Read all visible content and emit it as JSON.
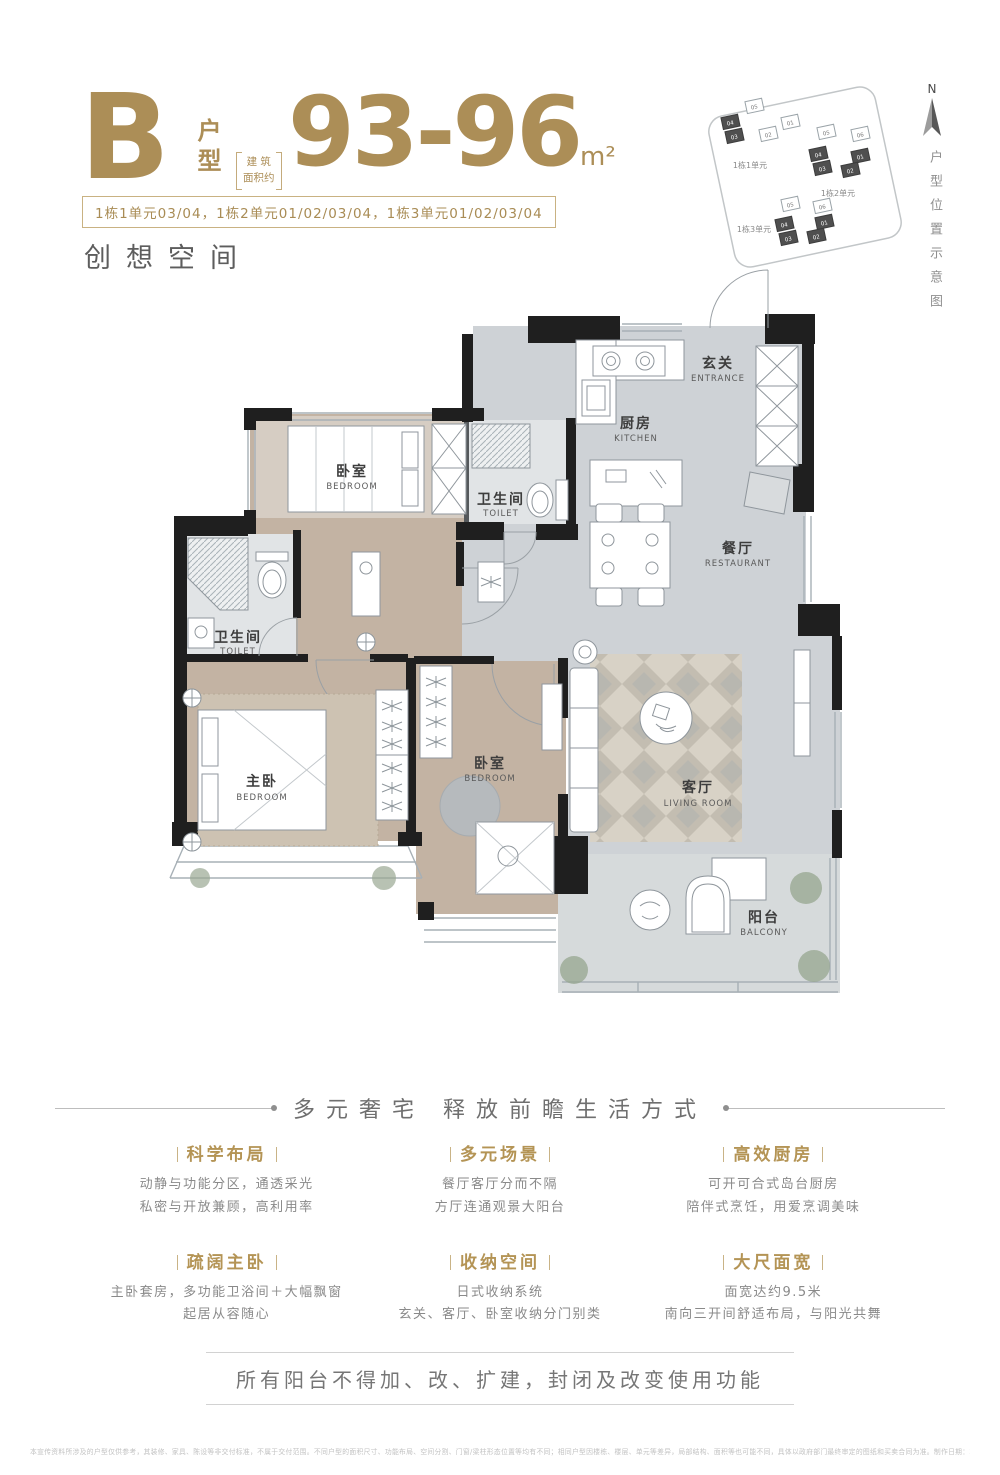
{
  "header": {
    "type_letter": "B",
    "type_label": "户型",
    "area_note1": "建 筑",
    "area_note2": "面积约",
    "area_value": "93-96",
    "area_unit": "m²",
    "units_line": "1栋1单元03/04，1栋2单元01/02/03/04，1栋3单元01/02/03/04",
    "slogan": "创想空间"
  },
  "site_plan": {
    "compass_label": "N",
    "side_caption": "户型位置示意图",
    "clusters": [
      {
        "label": "1栋1单元",
        "units": [
          {
            "num": "05"
          },
          {
            "num": "01"
          },
          {
            "num": "02"
          },
          {
            "num": "04"
          },
          {
            "num": "03"
          }
        ]
      },
      {
        "label": "1栋2单元",
        "units": [
          {
            "num": "05"
          },
          {
            "num": "06"
          },
          {
            "num": "04"
          },
          {
            "num": "03"
          },
          {
            "num": "01"
          },
          {
            "num": "02"
          }
        ]
      },
      {
        "label": "1栋3单元",
        "units": [
          {
            "num": "05"
          },
          {
            "num": "06"
          },
          {
            "num": "04"
          },
          {
            "num": "03"
          },
          {
            "num": "01"
          },
          {
            "num": "02"
          }
        ]
      }
    ]
  },
  "floor_plan": {
    "rooms": [
      {
        "cn": "玄关",
        "en": "ENTRANCE"
      },
      {
        "cn": "厨房",
        "en": "KITCHEN"
      },
      {
        "cn": "餐厅",
        "en": "RESTAURANT"
      },
      {
        "cn": "卫生间",
        "en": "TOILET"
      },
      {
        "cn": "卫生间",
        "en": "TOILET"
      },
      {
        "cn": "卧室",
        "en": "BEDROOM"
      },
      {
        "cn": "主卧",
        "en": "BEDROOM"
      },
      {
        "cn": "卧室",
        "en": "BEDROOM"
      },
      {
        "cn": "客厅",
        "en": "LIVING ROOM"
      },
      {
        "cn": "阳台",
        "en": "BALCONY"
      }
    ]
  },
  "tagline": "多元奢宅  释放前瞻生活方式",
  "features": [
    {
      "title": "科学布局",
      "line1": "动静与功能分区，通透采光",
      "line2": "私密与开放兼顾，高利用率"
    },
    {
      "title": "多元场景",
      "line1": "餐厅客厅分而不隔",
      "line2": "方厅连通观景大阳台"
    },
    {
      "title": "高效厨房",
      "line1": "可开可合式岛台厨房",
      "line2": "陪伴式烹饪，用爱烹调美味"
    },
    {
      "title": "疏阔主卧",
      "line1": "主卧套房，多功能卫浴间＋大幅飘窗",
      "line2": "起居从容随心"
    },
    {
      "title": "收纳空间",
      "line1": "日式收纳系统",
      "line2": "玄关、客厅、卧室收纳分门别类"
    },
    {
      "title": "大尺面宽",
      "line1": "面宽达约9.5米",
      "line2": "南向三开间舒适布局，与阳光共舞"
    }
  ],
  "notice": "所有阳台不得加、改、扩建，封闭及改变使用功能",
  "disclaimer": "本宣传资料所涉及的户型仅供参考，其装修、家具、陈设等非交付标准，不属于交付范围。不同户型的面积尺寸、功能布局、空间分割、门窗/梁柱形态位置等均有不同；相同户型因楼栋、楼层、单元等差异，局部结构、面积等也可能不同，具体以政府部门最终审定的图纸和买卖合同为准。制作日期：2022年3月",
  "colors": {
    "accent_gold": "#ac8e57",
    "wall_black": "#1f1f1f",
    "tile_gray": "#ced2d6",
    "wood": "#c3b3a3"
  }
}
